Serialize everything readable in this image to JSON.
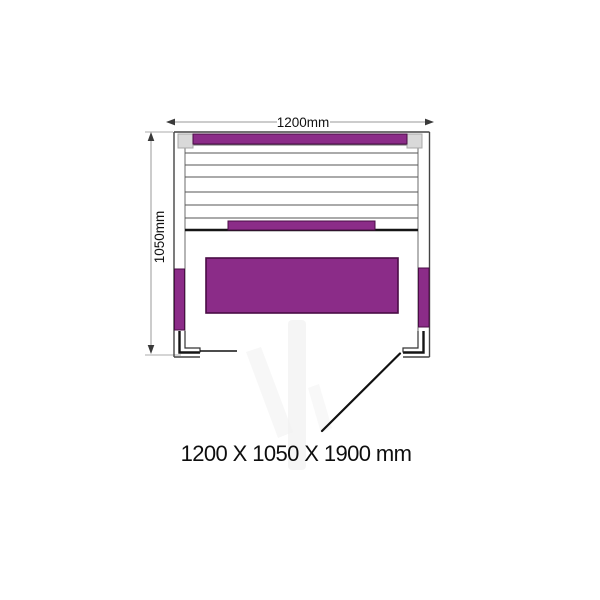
{
  "dimensions": {
    "width": "1200mm",
    "depth": "1050mm",
    "overall": "1200 X 1050 X 1900 mm"
  },
  "colors": {
    "background": "#ffffff",
    "heater": "#8b2c88",
    "heater_border": "#4a0d45",
    "outline": "#444444",
    "slat_line": "#555555",
    "dim_line": "#999999",
    "dim_text": "#111111",
    "corner_post": "#d9d9d9",
    "door_line": "#111111",
    "watermark": "#f1f1f1"
  },
  "diagram": {
    "type": "sauna-floor-plan-top-view",
    "parts": [
      "back-heater-panel",
      "bench-front-heater-panel",
      "bench-seat-panel",
      "left-side-heater",
      "right-side-heater",
      "bench-slats",
      "corner-posts",
      "left-door-jamb",
      "right-door-jamb",
      "door-swing-line"
    ]
  }
}
